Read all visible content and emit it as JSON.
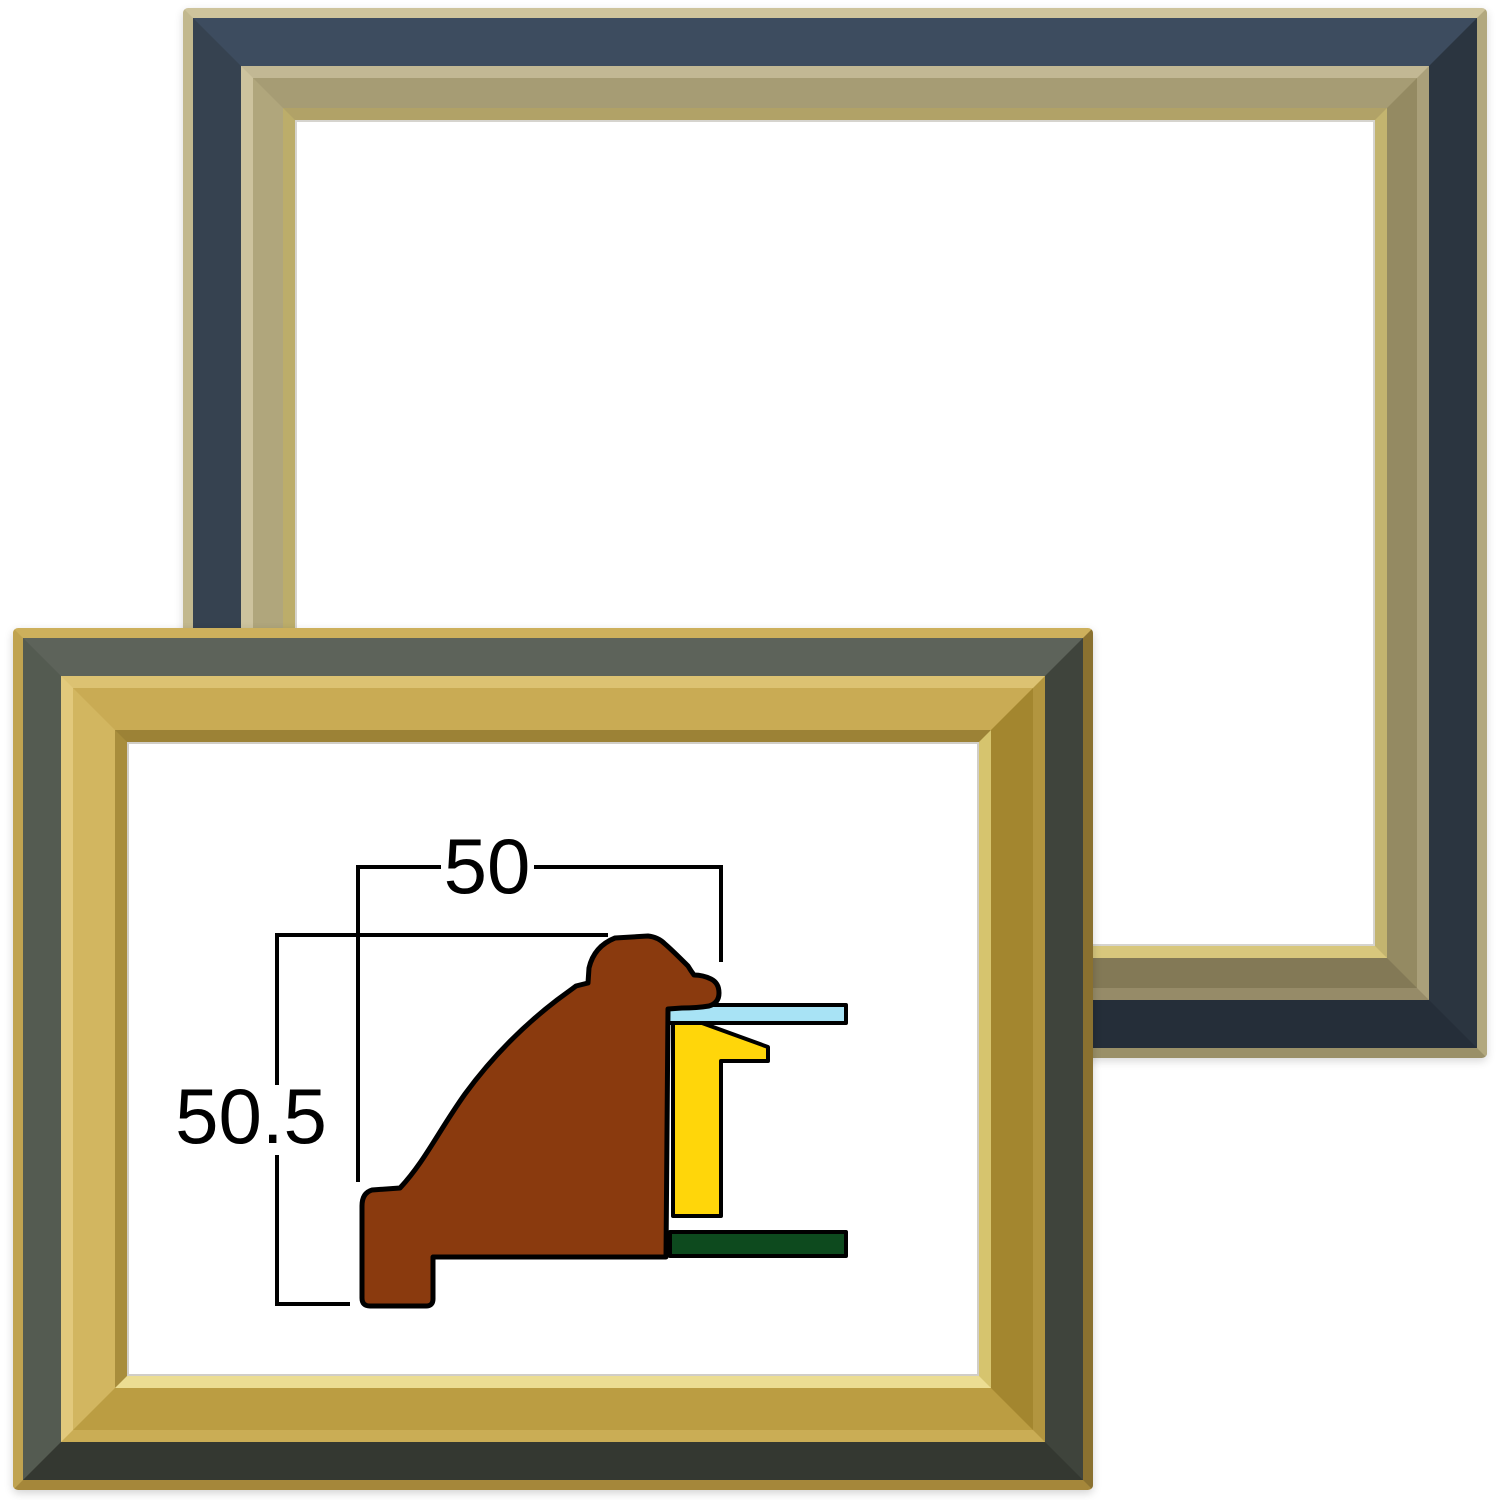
{
  "scene": {
    "background_color": "#ffffff",
    "description": "Two empty picture frames shown corner-to-corner with a moulding cross-section dimension drawing inside the front frame"
  },
  "diagram": {
    "width_label": "50",
    "height_label": "50.5",
    "line_color": "#000000",
    "moulding_profile_color": "#8a3a0e",
    "glass_color": "#a8e3f5",
    "liner_color": "#ffd60a",
    "backboard_color": "#0d4a1e"
  },
  "frames": {
    "back_frame": {
      "band_color": "#2f3a47",
      "moulding_color": "#a3976e",
      "lip_color": "#d2c074",
      "edge_color": "#c2b88e"
    },
    "front_frame": {
      "band_color": "#4c524a",
      "moulding_color": "#c9ab54",
      "lip_color": "#e5d687",
      "edge_color": "#c0a350"
    }
  }
}
